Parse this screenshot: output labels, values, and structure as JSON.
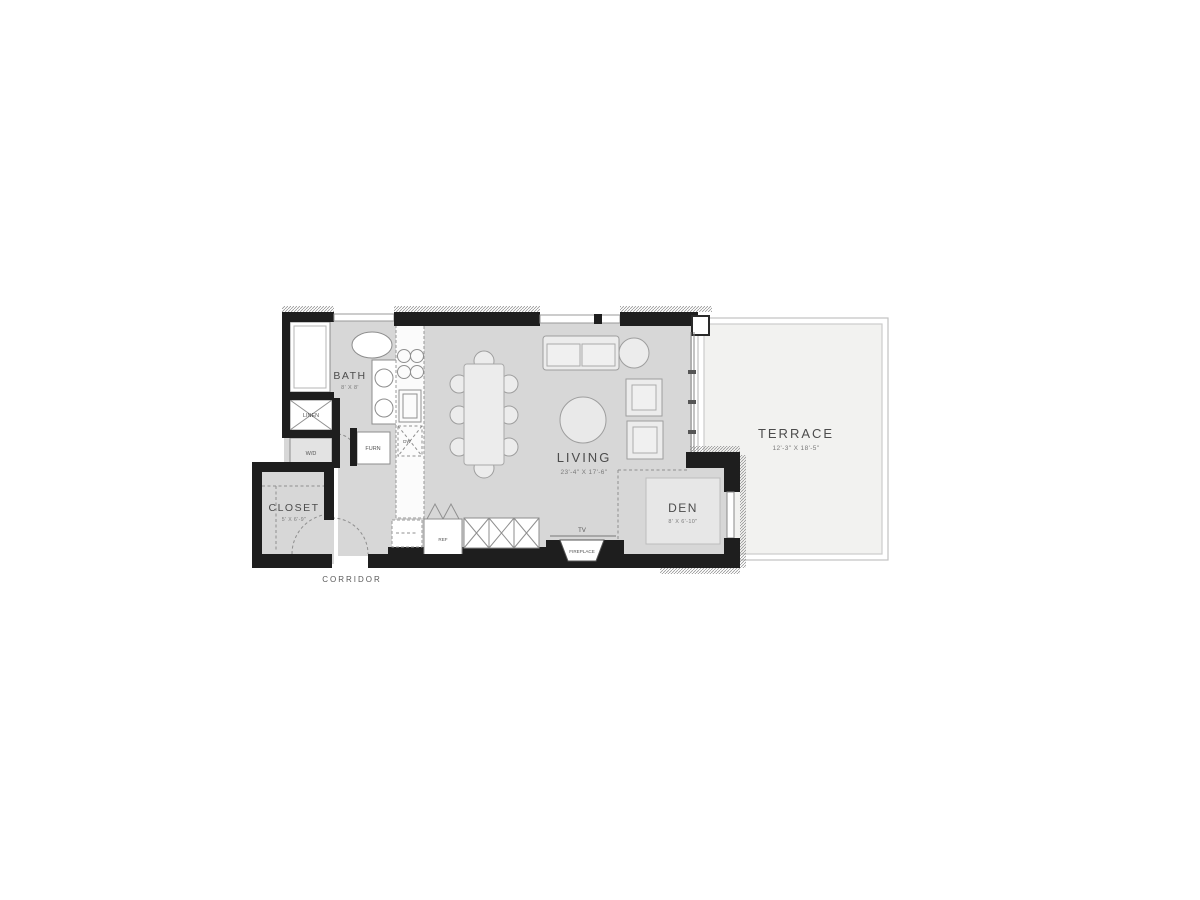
{
  "plan": {
    "rooms": {
      "bath": {
        "label": "BATH",
        "dims": "8' X 8'"
      },
      "closet": {
        "label": "CLOSET",
        "dims": "5' X 6'-9\""
      },
      "living": {
        "label": "LIVING",
        "dims": "23'-4\" X 17'-6\""
      },
      "den": {
        "label": "DEN",
        "dims": "8' X 6'-10\""
      },
      "terrace": {
        "label": "TERRACE",
        "dims": "12'-3\" X 18'-5\""
      },
      "corridor": {
        "label": "CORRIDOR"
      }
    },
    "fixtures": {
      "linen": "LINEN",
      "washer_dryer": "W/D",
      "furnace": "FURN",
      "dishwasher": "DW",
      "refrigerator": "REF",
      "tv": "TV",
      "fireplace": "FIREPLACE"
    },
    "colors": {
      "wall": "#1e1e1e",
      "floor": "#d7d7d7",
      "terrace_floor": "#f2f2f0",
      "fixture_stroke": "#8c8c8c",
      "label_text": "#4a4a4a"
    }
  }
}
